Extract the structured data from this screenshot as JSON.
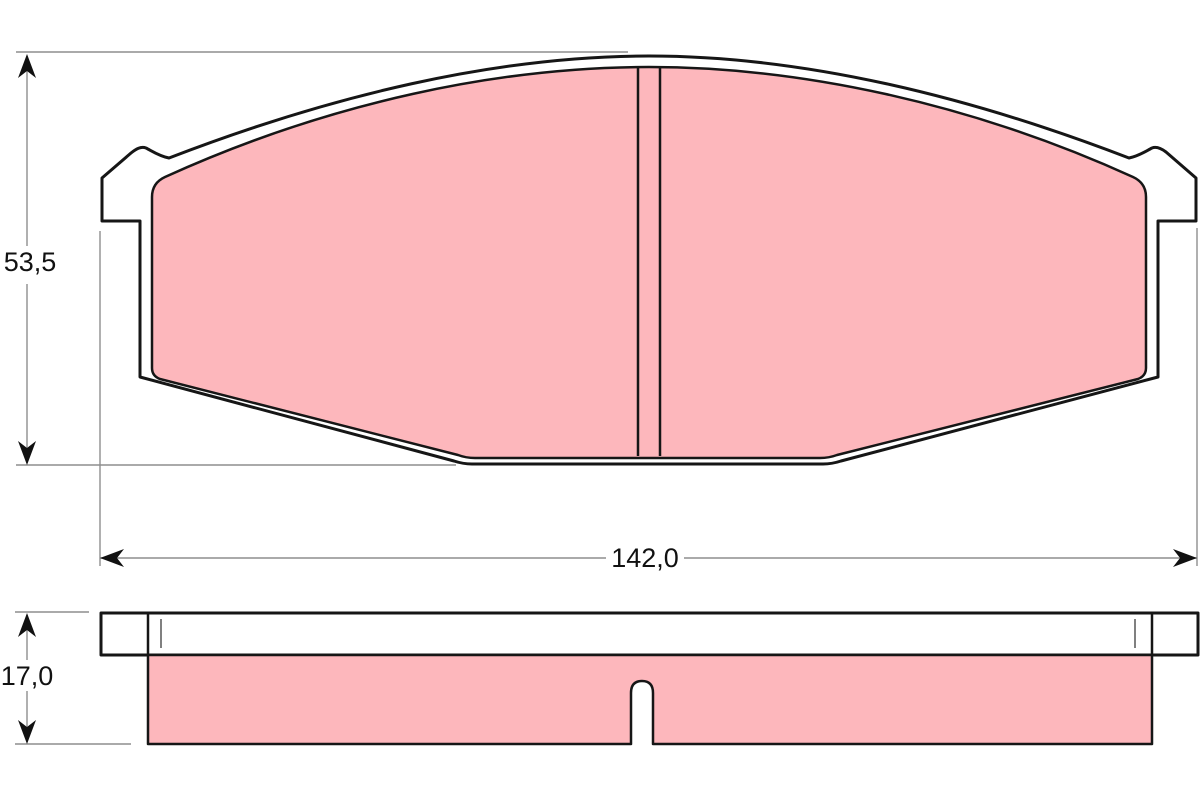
{
  "drawing": {
    "dimensions": {
      "height": {
        "label": "53,5"
      },
      "width": {
        "label": "142,0"
      },
      "thickness": {
        "label": "17,0"
      }
    },
    "colors": {
      "friction_material": "#fdb7bc",
      "backing_plate": "#ffffff",
      "outline": "#161616",
      "dimension_line": "#8e8e8e",
      "text": "#111111",
      "background": "#ffffff"
    }
  }
}
